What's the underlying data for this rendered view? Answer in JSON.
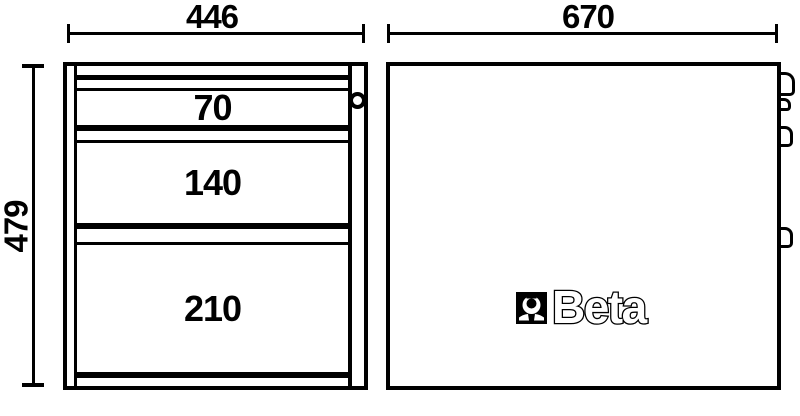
{
  "colors": {
    "background": "#ffffff",
    "line": "#000000"
  },
  "front_view": {
    "width_dim": "446",
    "height_dim": "479",
    "drawers": [
      {
        "label": "70"
      },
      {
        "label": "140"
      },
      {
        "label": "210"
      }
    ]
  },
  "side_view": {
    "width_dim": "670",
    "brand_logo_text": "Beta"
  }
}
